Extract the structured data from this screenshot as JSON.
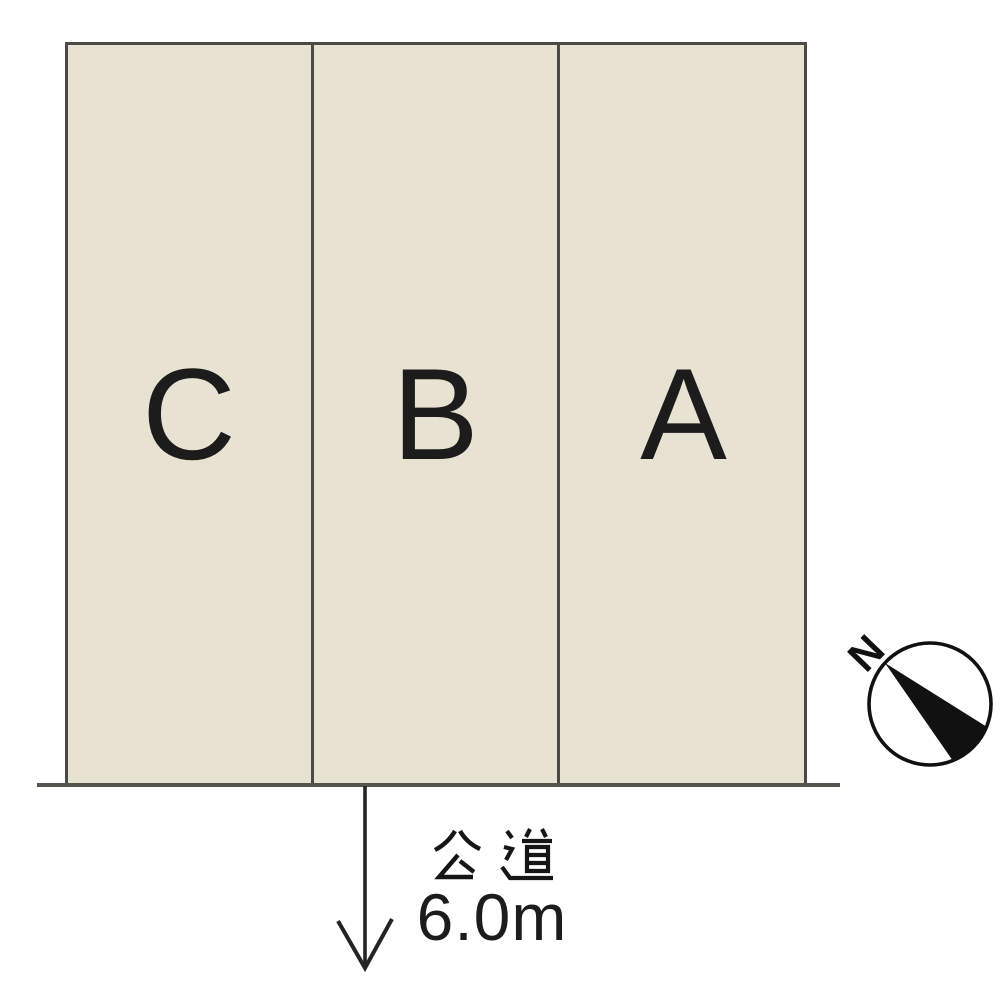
{
  "diagram": {
    "lots": [
      {
        "label": "C"
      },
      {
        "label": "B"
      },
      {
        "label": "A"
      }
    ],
    "road": {
      "name": "公道",
      "width_label": "6.0m"
    },
    "compass": {
      "north_label": "N"
    }
  },
  "colors": {
    "lot_fill": "#e8e2d2",
    "outline": "#4b4a44",
    "ground": "#55544d",
    "ink": "#1c1c1c"
  }
}
